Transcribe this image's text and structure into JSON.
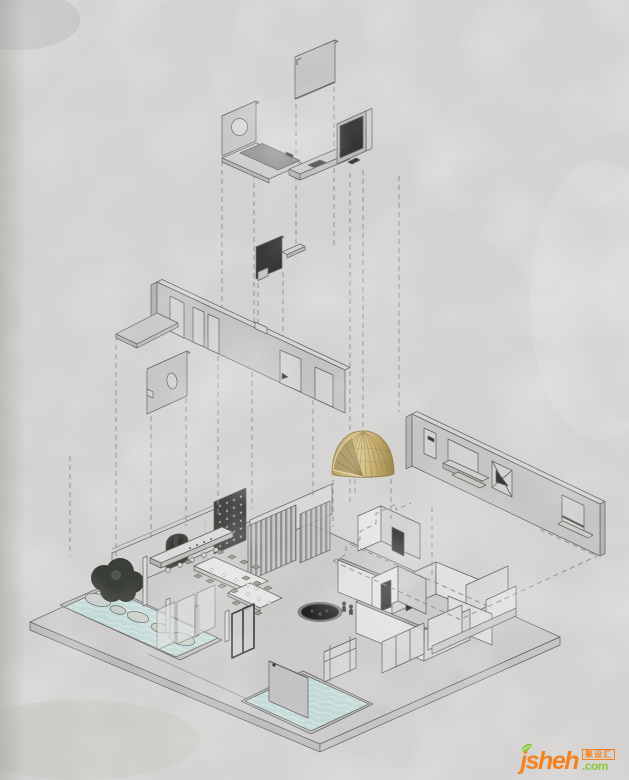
{
  "watermark": {
    "brand": "jsheh",
    "tld": ".com",
    "badge": "聚设汇"
  },
  "colors": {
    "bg": "#d7d6d4",
    "ink": "#5a5855",
    "dash": "#8f8e8c",
    "panel": "#c7c6c4",
    "panel_light": "#d9d8d6",
    "panel_dark": "#b0afad",
    "wall_white": "#e9e8e6",
    "dark_panel": "#262624",
    "slab": "#cfcecc",
    "water": "#c3dedc",
    "water_light": "#e6f1ef",
    "gold": "#c9ae63",
    "gold_dark": "#8f7a3c",
    "gold_deep": "#6f5d2c",
    "tree": "#2f332e",
    "wm_orange": "#f5821f",
    "wm_green": "#8dc63f"
  },
  "scene": {
    "type": "exploded-axonometric-interior-diagram",
    "parts": [
      "ceiling-panel",
      "feature-panel-with-circle-and-counter",
      "media-wall-with-bench",
      "dark-accent-panel-with-shelf",
      "door-wall-elevation-with-platform",
      "oval-window-panel",
      "gold-ribbed-dome",
      "window-wall-elevation",
      "floor-plan-with-pools-dining-furniture",
      "dashed-projection-lines",
      "dashed-footprint-outline"
    ]
  }
}
